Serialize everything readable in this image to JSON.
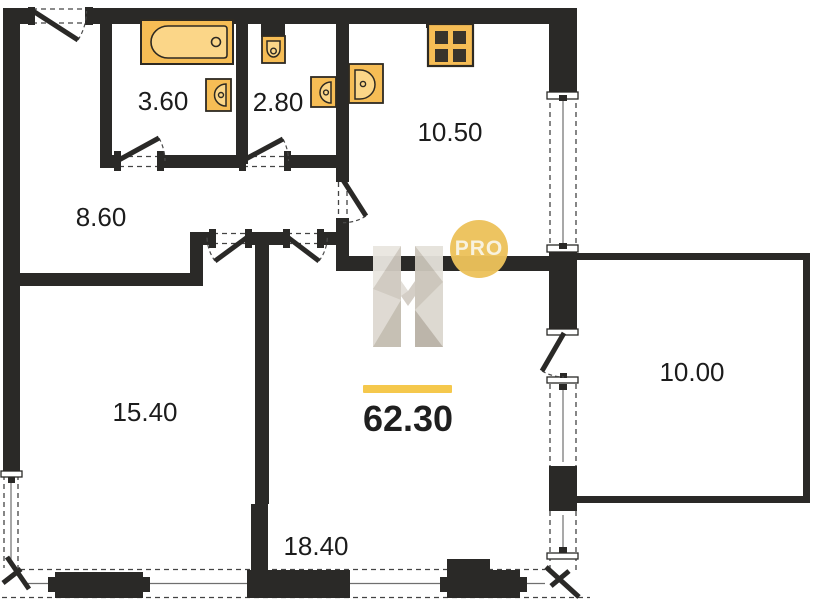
{
  "plan": {
    "rooms": [
      {
        "id": "bathroom",
        "area": "3.60"
      },
      {
        "id": "toilet",
        "area": "2.80"
      },
      {
        "id": "kitchen",
        "area": "10.50"
      },
      {
        "id": "hallway",
        "area": "8.60"
      },
      {
        "id": "living-room",
        "area": "15.40"
      },
      {
        "id": "bedroom",
        "area": "18.40"
      },
      {
        "id": "balcony",
        "area": "10.00"
      }
    ],
    "total_area": "62.30",
    "watermark": {
      "letter": "H",
      "badge": "PRO"
    },
    "colors": {
      "wall": "#2a2927",
      "fixture": "#f6bd55",
      "fixture_light": "#fbd688",
      "badge_yellow": "#ecc25b",
      "underline_yellow": "#f5c84c",
      "text": "#1c1c1c"
    },
    "icons": [
      "bathtub-icon",
      "bathroom-sink-icon",
      "toilet-icon",
      "toilet-sink-icon",
      "kitchen-sink-icon",
      "stove-icon",
      "logo-h-icon",
      "logo-pro-badge"
    ]
  }
}
